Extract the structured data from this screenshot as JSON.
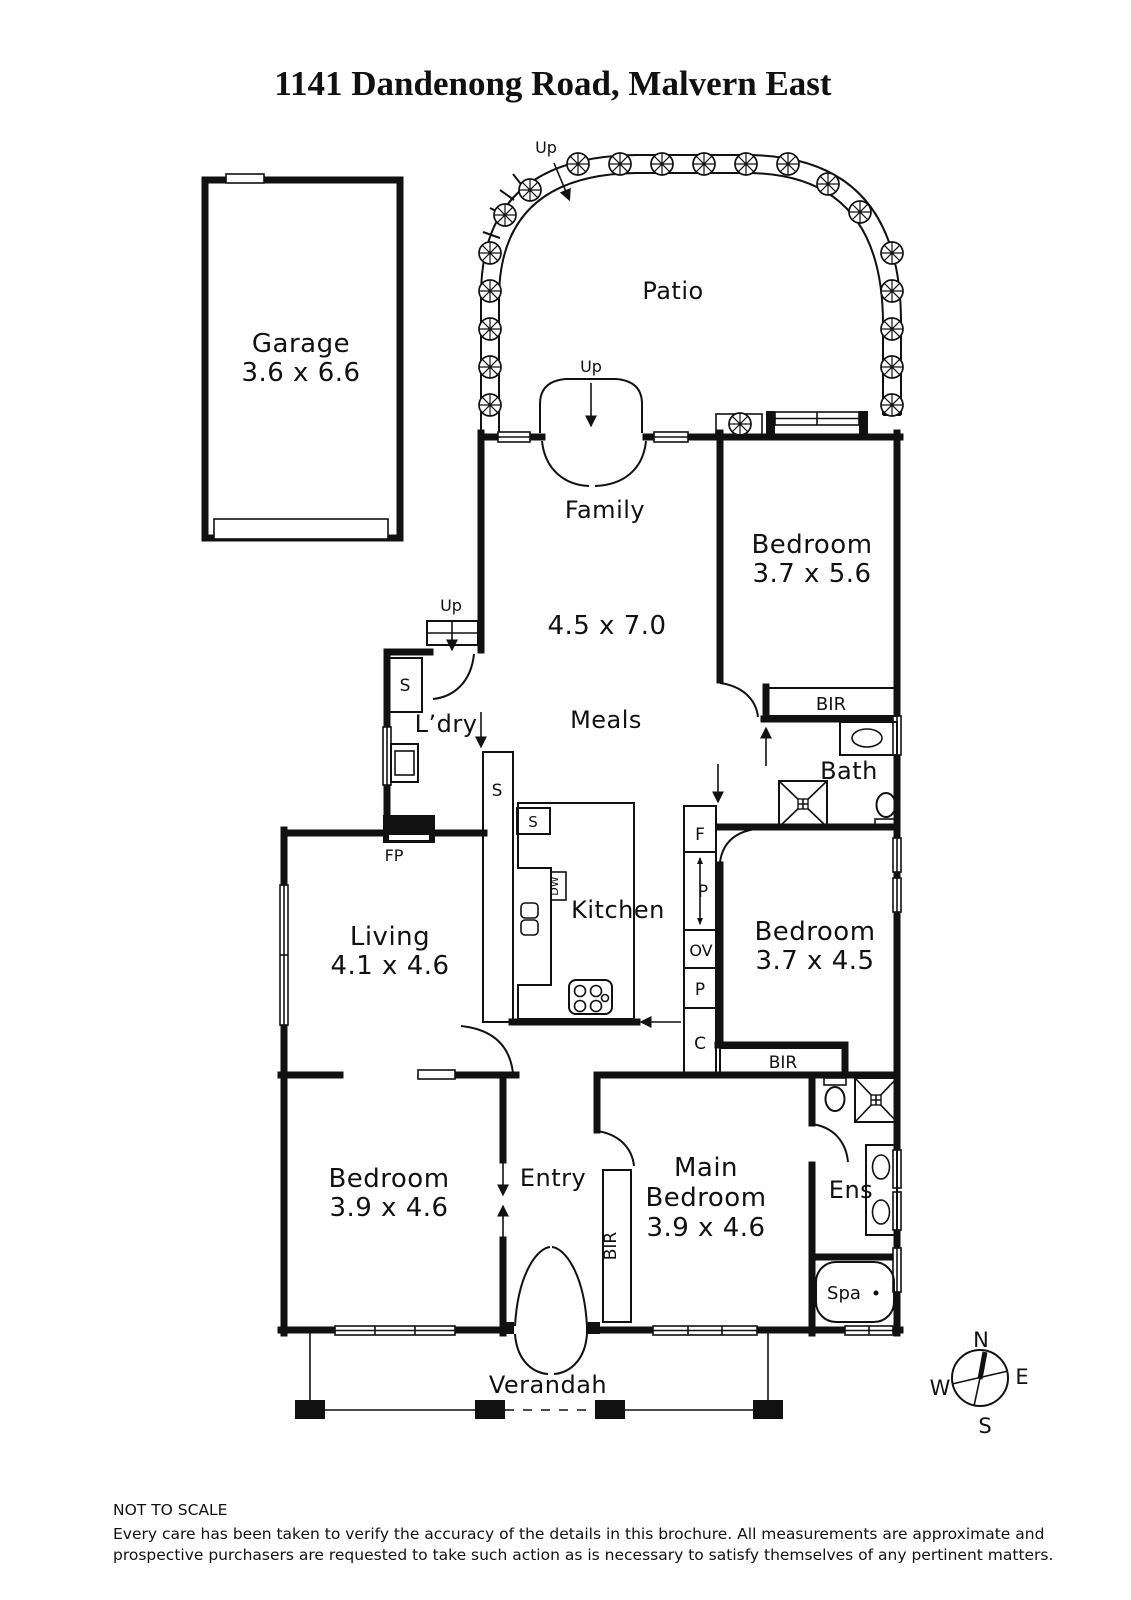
{
  "title": "1141 Dandenong Road, Malvern East",
  "rooms": {
    "garage": {
      "name": "Garage",
      "dims": "3.6 x 6.6"
    },
    "patio": {
      "name": "Patio"
    },
    "family": {
      "name": "Family",
      "dims": "4.5 x 7.0"
    },
    "meals": {
      "name": "Meals"
    },
    "bedroom1": {
      "name": "Bedroom",
      "dims": "3.7 x 5.6"
    },
    "laundry": {
      "name": "L’dry"
    },
    "bath": {
      "name": "Bath"
    },
    "kitchen": {
      "name": "Kitchen"
    },
    "bedroom2": {
      "name": "Bedroom",
      "dims": "3.7 x 4.5"
    },
    "living": {
      "name": "Living",
      "dims": "4.1 x 4.6"
    },
    "bedroom3": {
      "name": "Bedroom",
      "dims": "3.9 x 4.6"
    },
    "entry": {
      "name": "Entry"
    },
    "main_bedroom": {
      "line1": "Main",
      "line2": "Bedroom",
      "dims": "3.9 x 4.6"
    },
    "ensuite": {
      "name": "Ens"
    },
    "spa": {
      "name": "Spa"
    },
    "verandah": {
      "name": "Verandah"
    }
  },
  "fixtures": {
    "fireplace": "FP",
    "dishwasher": "DW",
    "fridge": "F",
    "pantry_upper": "P",
    "oven": "OV",
    "pantry_lower": "P",
    "cupboard": "C",
    "storage_laundry": "S",
    "storage_meals": "S",
    "storage_kitchen": "S",
    "robe_bedroom1": "BIR",
    "robe_bedroom2": "BIR",
    "robe_main": "BIR"
  },
  "stairs": {
    "patio_up": "Up",
    "family_up": "Up",
    "laundry_up": "Up"
  },
  "compass": {
    "north": "N",
    "east": "E",
    "south": "S",
    "west": "W"
  },
  "footer": {
    "scale_note": "NOT TO SCALE",
    "disclaimer_line1": "Every care has been taken to verify the accuracy of the details in this brochure. All measurements are approximate and",
    "disclaimer_line2": "prospective purchasers are requested to take such action as is necessary to satisfy themselves of any pertinent matters."
  },
  "colors": {
    "ink": "#111111",
    "background": "#ffffff"
  }
}
